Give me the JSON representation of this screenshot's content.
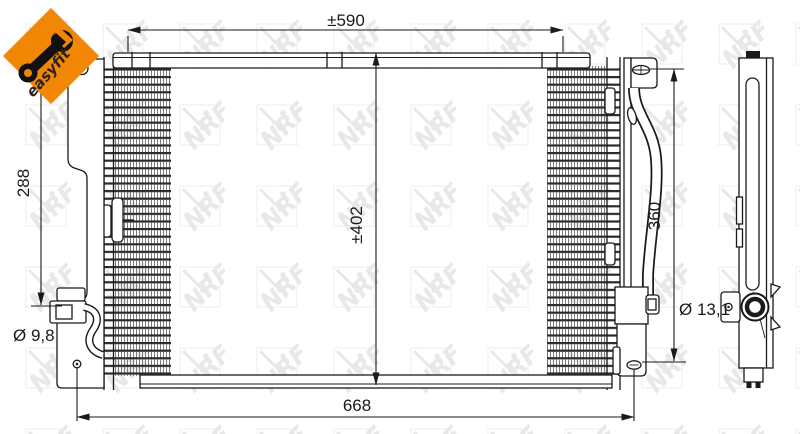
{
  "logo": {
    "brand": "easyfit",
    "bg_color": "#F28705",
    "wrench_color": "#111111",
    "text_color": "#2b2320"
  },
  "watermark": {
    "text": "NRF",
    "color": "#e8e8e8"
  },
  "drawing": {
    "line_color": "#1a1a1a",
    "subject": "condenser-technical-drawing",
    "dimensions": {
      "top_width": "±590",
      "core_height": "±402",
      "left_mount_span": "288",
      "right_mount_span": "360",
      "overall_width": "668",
      "left_hole_diameter": "Ø 9,8",
      "port_diameter": "Ø 13,1"
    }
  }
}
